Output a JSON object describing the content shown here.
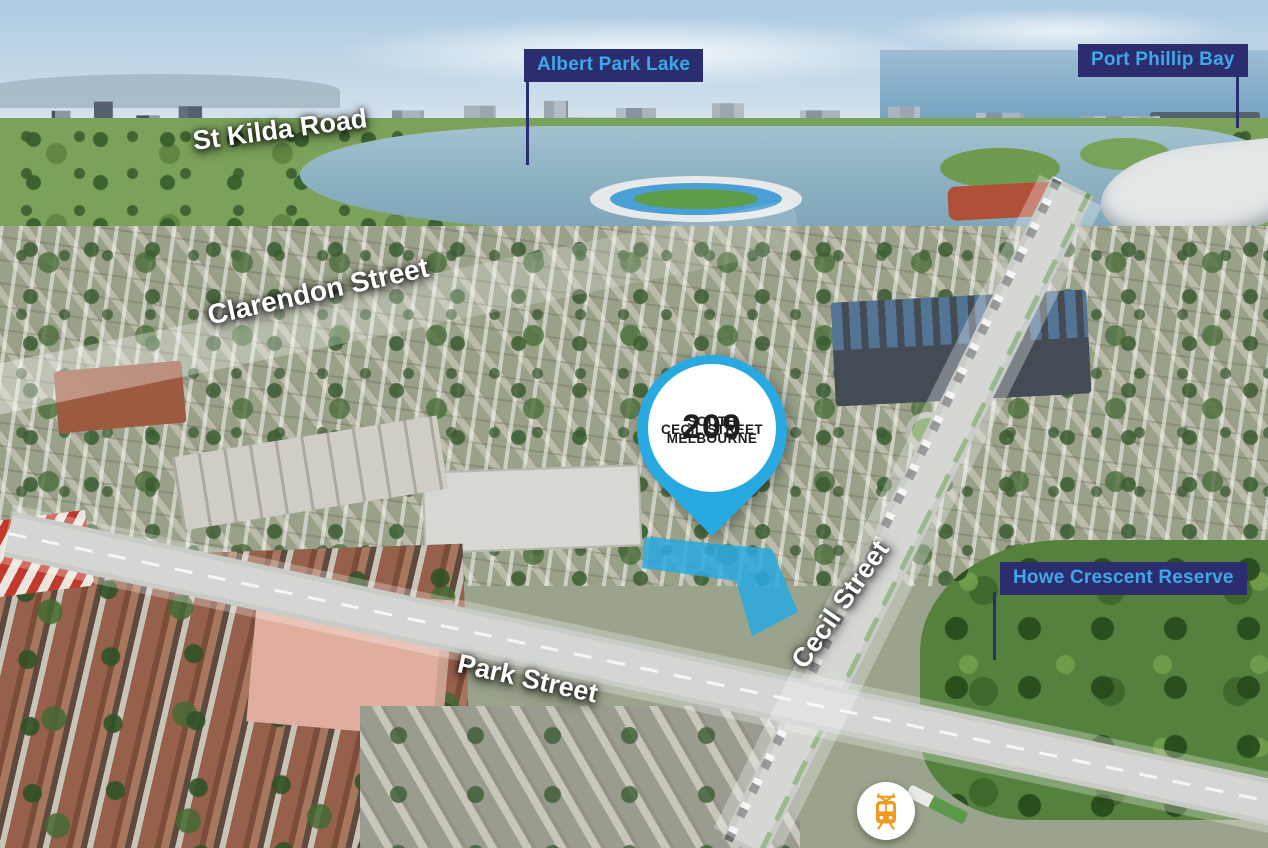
{
  "page": {
    "type": "aerial-property-locator",
    "suburb": "South Melbourne"
  },
  "callouts": {
    "albert_park_lake": "Albert Park Lake",
    "port_phillip_bay": "Port Phillip Bay",
    "howe_crescent_reserve": "Howe Crescent Reserve"
  },
  "street_labels": {
    "st_kilda_road": "St Kilda Road",
    "clarendon_street": "Clarendon Street",
    "cecil_street": "Cecil Street",
    "park_street": "Park Street"
  },
  "property_pin": {
    "number": "209",
    "street": "CECIL STREET",
    "suburb_line1": "SOUTH",
    "suburb_line2": "MELBOURNE"
  },
  "icons": {
    "tram": "tram-icon"
  },
  "colors": {
    "callout_bg": "#2b2d6e",
    "callout_text": "#3fa8e8",
    "pin_blue": "#29a9e1",
    "property_highlight": "#29a9e1",
    "tram_orange": "#f09a1f",
    "street_text": "#ffffff"
  }
}
